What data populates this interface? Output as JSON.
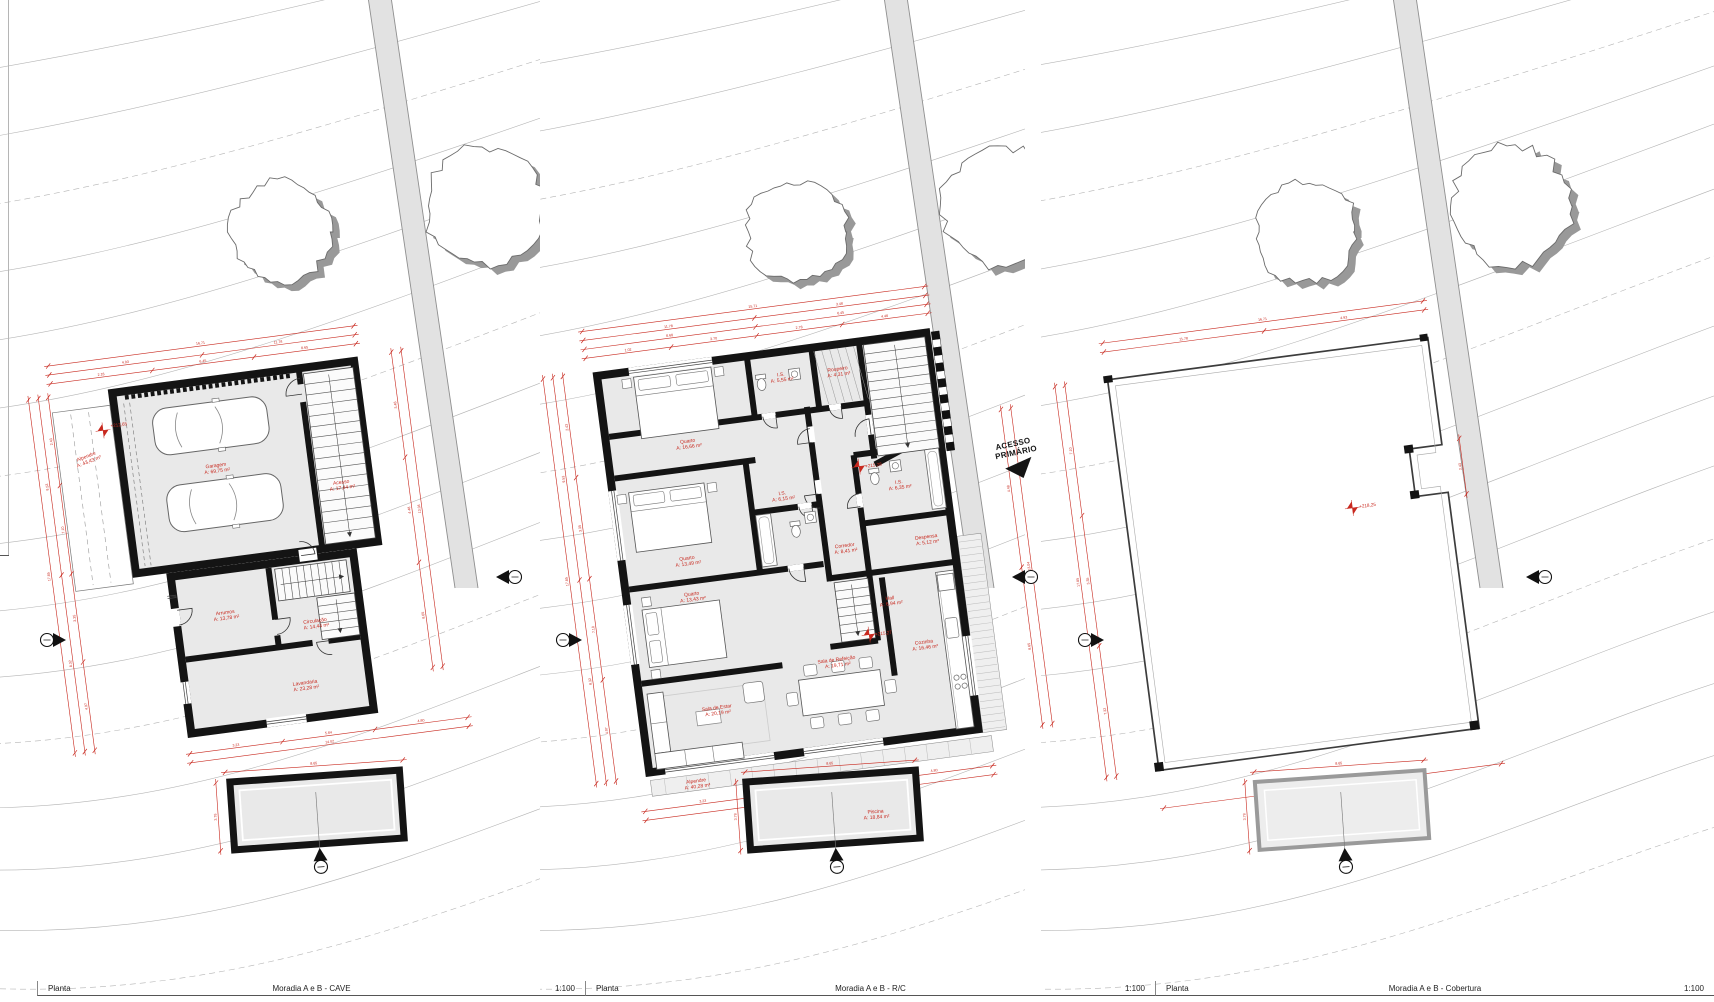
{
  "colors": {
    "dimension_red": "#c8281e",
    "wall_black": "#141414",
    "floor_gray": "#e9e9e9",
    "contour_gray": "#b5b5b5",
    "tree_shadow_gray": "#999999",
    "road_gray": "#e2e2e2"
  },
  "panels": [
    {
      "id": "cave",
      "footer": {
        "label": "Planta",
        "title": "Moradia A e B - CAVE",
        "scale": "1:100"
      },
      "levels": [
        {
          "text": "+212,65"
        }
      ],
      "rooms": [
        {
          "name": "Alpendre",
          "area": "A: 43,43 m²"
        },
        {
          "name": "Garagem",
          "area": "A: 69,75 m²"
        },
        {
          "name": "Acesso",
          "area": "A: 17,44 m²"
        },
        {
          "name": "Arrumos",
          "area": "A: 13,78 m²"
        },
        {
          "name": "Circulação",
          "area": "A: 14,44 m²"
        },
        {
          "name": "Lavandaria",
          "area": "A: 23,28 m²"
        }
      ],
      "dims": {
        "chains": [
          [
            "2.18",
            "6.45",
            "8.65"
          ],
          [
            "4.93",
            "11.78"
          ],
          [
            "16.71"
          ],
          [
            "2.43",
            "7.10",
            "3.35",
            "4.97"
          ],
          [
            "9.53",
            "8.32"
          ],
          [
            "17.85"
          ],
          [
            "3.48",
            "4.48",
            "8.65"
          ],
          [
            "13.04"
          ],
          [
            "3.23",
            "5.84",
            "4.80"
          ],
          [
            "14.02"
          ],
          [
            "8.65"
          ],
          [
            "3.78"
          ]
        ]
      }
    },
    {
      "id": "rc",
      "footer": {
        "label": "Planta",
        "title": "Moradia A e B - R/C",
        "scale": "1:100"
      },
      "levels": [
        {
          "text": "+215,28"
        },
        {
          "text": "+215,27"
        }
      ],
      "access_note": {
        "line1": "ACESSO",
        "line2": "PRIMÁRIO"
      },
      "rooms": [
        {
          "name": "Quarto",
          "area": "A: 16,66 m²"
        },
        {
          "name": "I.S.",
          "area": "A: 5,55 m²"
        },
        {
          "name": "Roupeiro",
          "area": "A: 4,31 m²"
        },
        {
          "name": "Quarto",
          "area": "A: 13,49 m²"
        },
        {
          "name": "I.S.",
          "area": "A: 6,15 m²"
        },
        {
          "name": "I.S.",
          "area": "A: 6,35 m²"
        },
        {
          "name": "Corredor",
          "area": "A: 8,41 m²"
        },
        {
          "name": "Quarto",
          "area": "A: 13,43 m²"
        },
        {
          "name": "Sala de Estar",
          "area": "A: 20,19 m²"
        },
        {
          "name": "Sala de Refeição",
          "area": "A: 19,71 m²"
        },
        {
          "name": "Hall",
          "area": "A: 6,94 m²"
        },
        {
          "name": "Despensa",
          "area": "A: 5,12 m²"
        },
        {
          "name": "Cozinha",
          "area": "A: 16,46 m²"
        },
        {
          "name": "Alpendre",
          "area": "A: 40,28 m²"
        },
        {
          "name": "Piscina",
          "area": "A: 18,84 m²"
        }
      ],
      "dims": {
        "chains": [
          [
            "1.02",
            "3.70",
            "2.78",
            "4.48"
          ],
          [
            "8.68",
            "6.45"
          ],
          [
            "11.78",
            "3.48"
          ],
          [
            "15.71"
          ],
          [
            "2.43",
            "3.35",
            "7.10",
            "4.97"
          ],
          [
            "9.53",
            "8.32"
          ],
          [
            "17.85"
          ],
          [
            "4.48",
            "8.65"
          ],
          [
            "13.04"
          ],
          [
            "3.23",
            "5.84",
            "4.80"
          ],
          [
            "14.02"
          ],
          [
            "8.65"
          ],
          [
            "3.78"
          ]
        ]
      }
    },
    {
      "id": "cobertura",
      "footer": {
        "label": "Planta",
        "title": "Moradia A e B - Cobertura",
        "scale": "1:100"
      },
      "levels": [
        {
          "text": "+218,25"
        }
      ],
      "rooms": [],
      "dims": {
        "chains": [
          [
            "11.78",
            "4.93"
          ],
          [
            "16.71"
          ],
          [
            "7.10",
            "3.35",
            "7.32"
          ],
          [
            "17.85"
          ],
          [
            "2.43"
          ],
          [
            "14.02"
          ],
          [
            "8.65"
          ],
          [
            "3.78"
          ]
        ]
      }
    }
  ]
}
